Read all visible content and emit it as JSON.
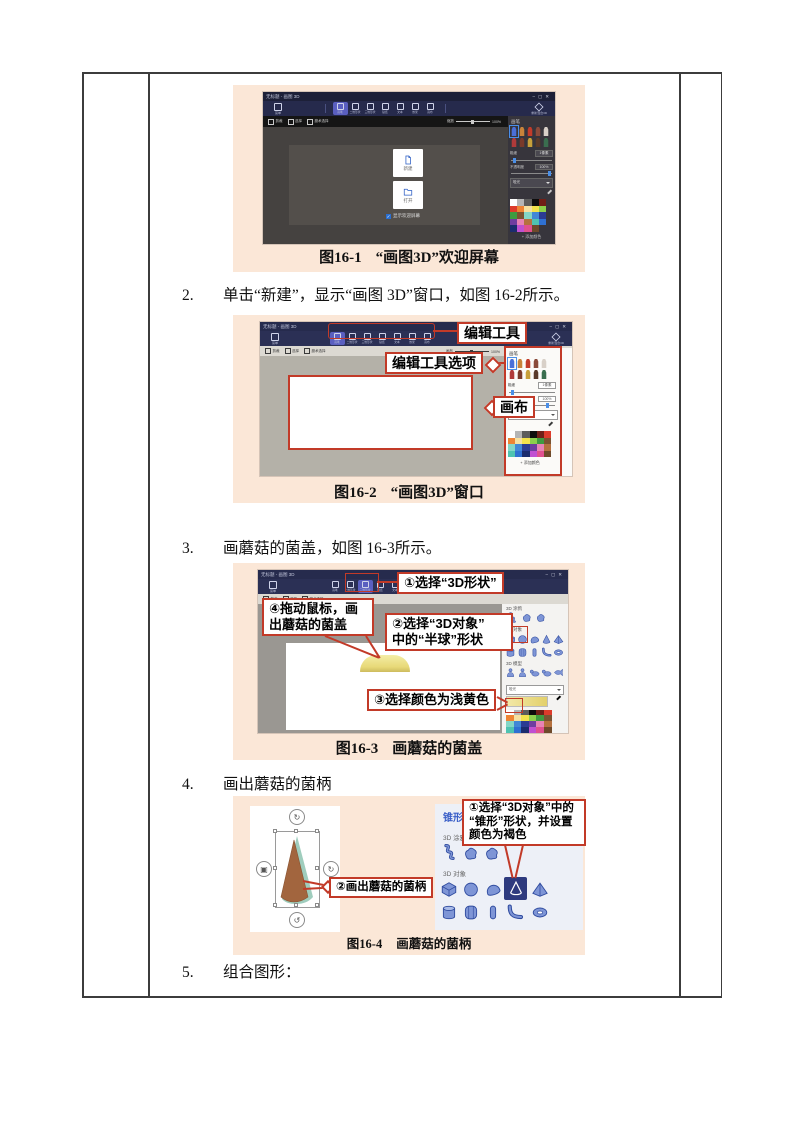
{
  "page": {
    "steps": [
      {
        "num": "2.",
        "text": "单击“新建”，显示“画图 3D”窗口，如图 16-2所示。"
      },
      {
        "num": "3.",
        "text": "画蘑菇的菌盖，如图 16-3所示。"
      },
      {
        "num": "4.",
        "text": "画出蘑菇的菌柄"
      },
      {
        "num": "5.",
        "text": "组合图形："
      }
    ],
    "captions": [
      {
        "label": "图16-1",
        "text": "“画图3D”欢迎屏幕"
      },
      {
        "label": "图16-2",
        "text": "“画图3D”窗口"
      },
      {
        "label": "图16-3",
        "text": "画蘑菇的菌盖"
      },
      {
        "label": "图16-4",
        "text": "画蘑菇的菌柄"
      }
    ]
  },
  "callouts": {
    "fig2": {
      "edit_tools": "编辑工具",
      "edit_tool_options": "编辑工具选项",
      "canvas": "画布"
    },
    "fig3": {
      "c1": "①选择“3D形状”",
      "c4_line1": "④拖动鼠标，画",
      "c4_line2": "出蘑菇的菌盖",
      "c2_line1": "②选择“3D对象”",
      "c2_line2": "中的“半球”形状",
      "c3": "③选择颜色为浅黄色"
    },
    "fig4": {
      "c1_line1": "①选择“3D对象”中的",
      "c1_line2": "“锥形”形状，并设置",
      "c1_line3": "颜色为褐色",
      "c2": "②画出蘑菇的菌柄"
    }
  },
  "paint3d": {
    "title": "无标题 - 画图 3D",
    "window": {
      "min": "–",
      "max": "▢",
      "close": "✕"
    },
    "menu_label": "菜单",
    "tools": [
      "画笔",
      "二维形状",
      "三维形状",
      "贴纸",
      "文本",
      "效果",
      "画布"
    ],
    "remix_label": "重新混合3D",
    "subbar": {
      "crop": "剪裁",
      "select": "选择",
      "magic": "魔术选择",
      "canvas": "画布",
      "zoom": "缩放",
      "zoom_value": "100%"
    },
    "welcome": {
      "new_label": "新建",
      "open_label": "打开",
      "show_label": "显示欢迎屏幕"
    },
    "panel": {
      "brushes_title": "画笔",
      "thickness": "粗细",
      "thickness_value": "1像素",
      "opacity": "不透明度",
      "opacity_value": "100%",
      "material": "哑光",
      "add_color": "+ 添加颜色",
      "doodle": "3D 涂鸦",
      "objects": "3D 对象",
      "models": "3D 模型",
      "cone_title": "锥形"
    },
    "colors": {
      "callout_red": "#c23a28",
      "peach_bg": "#fbe7d7",
      "accent_purple": "#5a5fc0",
      "titlebar_navy": "#20243f",
      "toolbar_navy": "#2a2f54",
      "selected_navy": "#2e3a7e",
      "mushroom_cap": "#e8d978",
      "mushroom_stem": "#a2653e",
      "stem_shadow": "#9fcdbd",
      "palette": [
        "#ffffff",
        "#b5b5b5",
        "#5c5c5c",
        "#0d0d0d",
        "#701f17",
        "#dd3b2b",
        "#ee8434",
        "#f6e0a0",
        "#f2e14c",
        "#8cd04c",
        "#3e9b40",
        "#7b5331",
        "#83d6c6",
        "#4187d6",
        "#2b3b93",
        "#6f3da0",
        "#e883b5",
        "#b5713f",
        "#4fc3b1",
        "#2f70d2",
        "#1b2c6e",
        "#c050d2",
        "#e0518f",
        "#6e4a2b"
      ],
      "brushes": [
        "#4a6fd8",
        "#c8833a",
        "#c23b2a",
        "#8a4a3a",
        "#d8d0c8",
        "#b03a3a",
        "#7a3a2a",
        "#c8a03a",
        "#5a3a2a",
        "#3a6e4f"
      ]
    }
  }
}
